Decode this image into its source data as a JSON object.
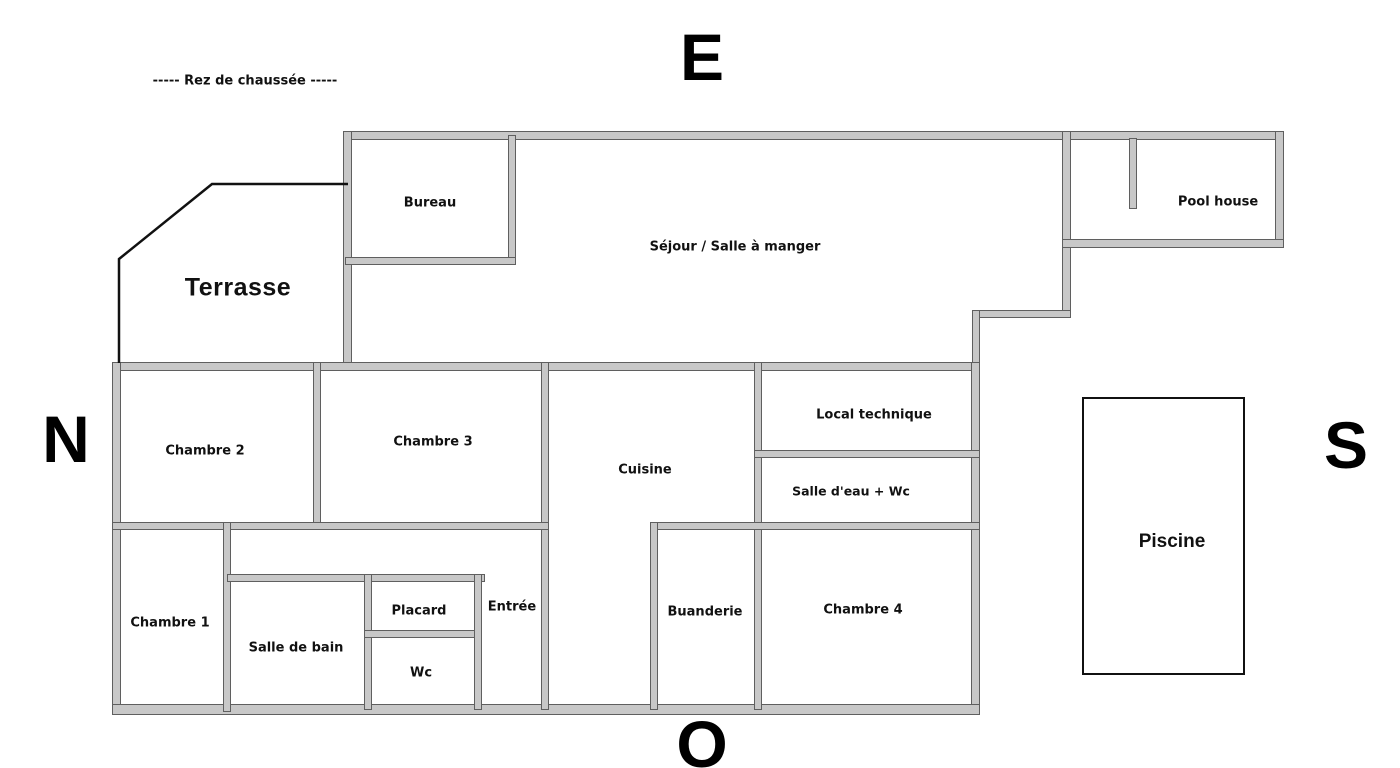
{
  "title": "-----  Rez de chaussée  -----",
  "compass": {
    "top": "E",
    "left": "N",
    "right": "S",
    "bottom": "O"
  },
  "floorplan": {
    "rooms": {
      "bureau": "Bureau",
      "sejour": "Séjour / Salle à manger",
      "pool_house": "Pool house",
      "terrasse": "Terrasse",
      "chambre2": "Chambre 2",
      "chambre3": "Chambre 3",
      "cuisine": "Cuisine",
      "local_technique": "Local technique",
      "salle_eau_wc": "Salle d'eau + Wc",
      "chambre1": "Chambre 1",
      "salle_de_bain": "Salle de bain",
      "placard": "Placard",
      "wc": "Wc",
      "entree": "Entrée",
      "buanderie": "Buanderie",
      "chambre4": "Chambre 4",
      "piscine": "Piscine"
    },
    "colors": {
      "wall_fill": "#c8c8c8",
      "wall_edge": "#5f5f5f",
      "terrace_line": "#111111",
      "pool_border": "#111111"
    }
  }
}
